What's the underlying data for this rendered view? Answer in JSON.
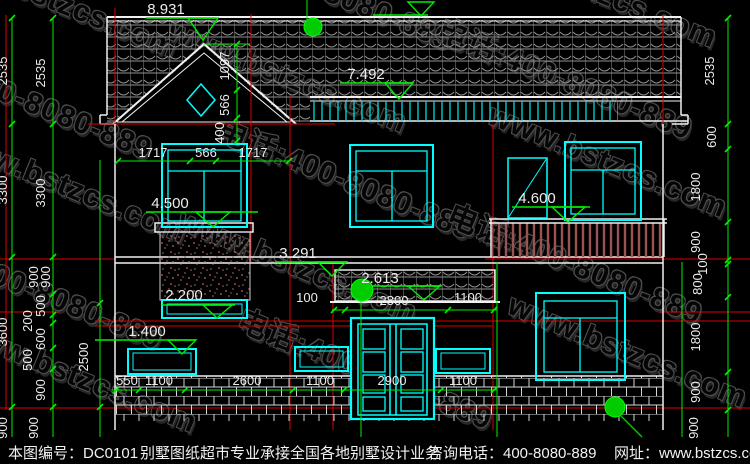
{
  "watermark": {
    "site": "www.bstzcs.com",
    "phone": "电话:400-8080-889"
  },
  "status_bar": {
    "drawing_no": "本图编号：DC0101",
    "service": "别墅图纸超市专业承接全国各地别墅设计业务",
    "phone": "咨询电话：400-8080-889",
    "website": "网址：www.bstzcs.com"
  },
  "levels": {
    "ridge": "8.931",
    "eaves": "7.492",
    "attic_left": "4.500",
    "attic_right": "4.600",
    "floor2": "3.291",
    "porch": "2.613",
    "stone_top": "2.200",
    "canopy": "1.400"
  },
  "dims": {
    "gable": [
      "1097",
      "566",
      "400"
    ],
    "attic_window": [
      "1717",
      "566",
      "1717"
    ],
    "porch": [
      "100",
      "2800",
      "1100"
    ],
    "ground": [
      "550",
      "1100",
      "2600",
      "1100",
      "2900",
      "1100"
    ],
    "left_outer": [
      "2535",
      "3300",
      "3600",
      "900"
    ],
    "left_inner": [
      "2535",
      "3300",
      "900",
      "900",
      "500",
      "200",
      "600",
      "500",
      "900",
      "900"
    ],
    "left_aux": "2500",
    "right": [
      "2535",
      "600",
      "1800",
      "900",
      "100",
      "800",
      "1800",
      "900",
      "900"
    ]
  }
}
